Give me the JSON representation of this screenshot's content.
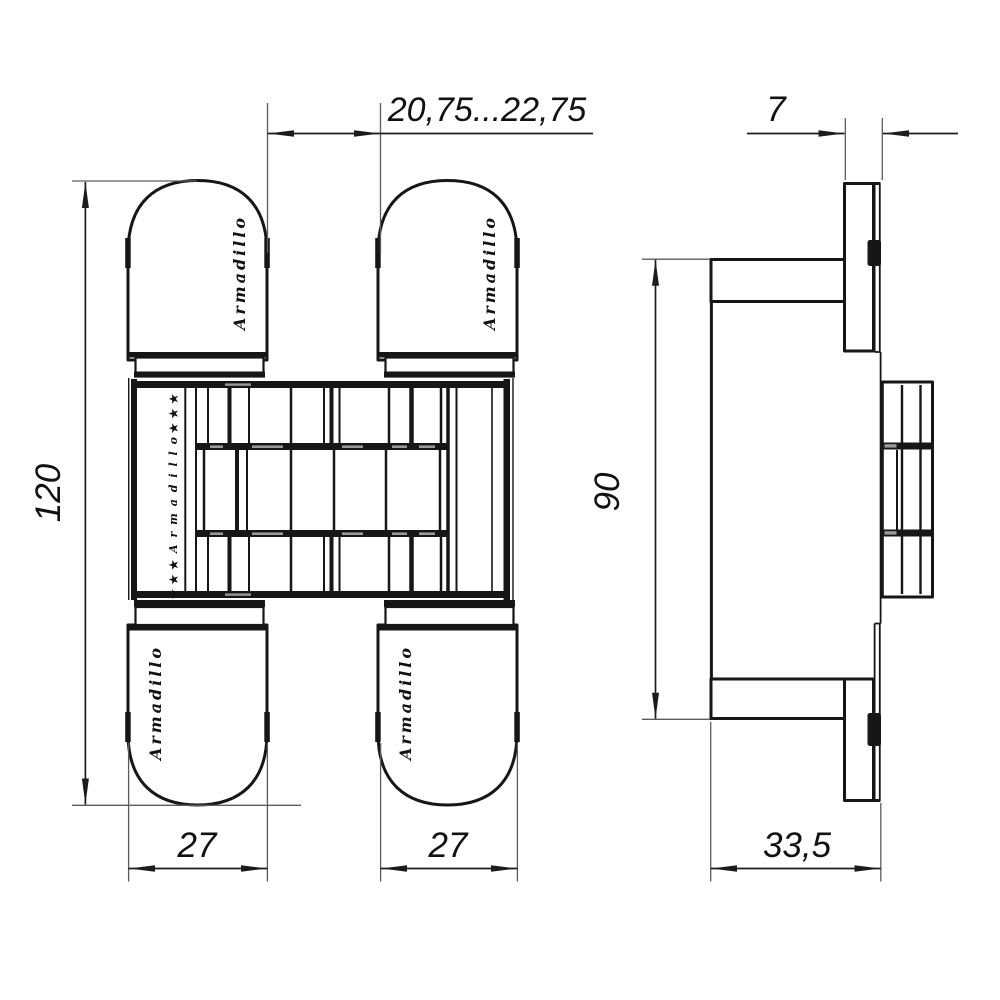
{
  "brand": {
    "name": "Armadillo"
  },
  "decor": {
    "stars_top": "★★★",
    "stars_bottom": "★★★",
    "column_text": "Armadillo"
  },
  "dimensions": {
    "total_height": "120",
    "door_gap_range": "20,75...22,75",
    "left_plate_width": "27",
    "right_plate_width": "27",
    "plate_thickness": "7",
    "body_height": "90",
    "body_depth": "33,5"
  },
  "colors": {
    "line": "#161616",
    "extension_line": "#5c5c5c",
    "background": "#ffffff"
  }
}
